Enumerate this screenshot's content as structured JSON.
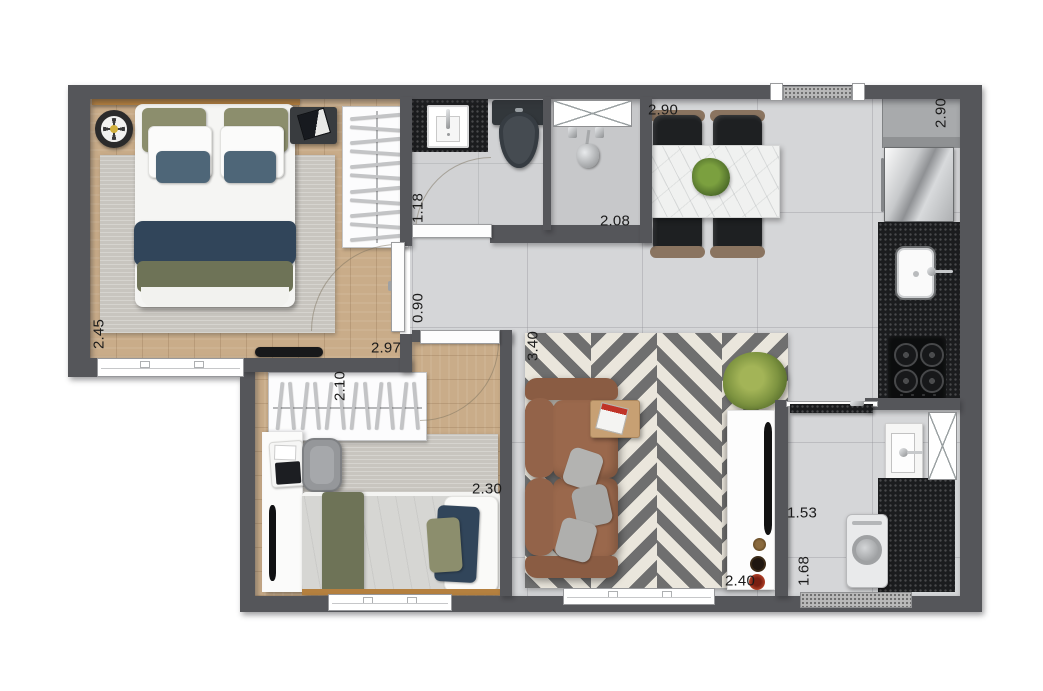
{
  "plan": {
    "dimensions": {
      "bedroom1": {
        "width": "2.45",
        "length": "2.97"
      },
      "bathroom": {
        "width": "1.18",
        "length": "2.08"
      },
      "hallway": {
        "width": "0.90"
      },
      "dining": {
        "width": "2.90"
      },
      "kitchen": {
        "depth": "2.90"
      },
      "living": {
        "length": "3.40",
        "width": "2.40"
      },
      "bedroom2": {
        "closet_width": "2.10",
        "width": "2.30"
      },
      "laundry": {
        "width": "1.53",
        "depth": "1.68"
      }
    },
    "palette": {
      "wall": "#55565a",
      "tile": "#d5d6d8",
      "wood": "#c9ac89",
      "rug": "#c8c5bf",
      "granite": "#1b1c1e",
      "granlight": "#b9b9b9",
      "chevdark": "#6f6f6f",
      "chevlight": "#eae6dc",
      "sofa": "#9a684c",
      "navy": "#31455a",
      "olive": "#6e7357",
      "pillowolive": "#8c8e6d",
      "pillowblue": "#4e6678",
      "headboard": "#b5803f",
      "marble": "#f0f1f0",
      "chairc": "#1e2022",
      "plantc": "#5d7d31",
      "countergray": "#a8aaac",
      "duvetgray": "#d6d6d3"
    }
  }
}
